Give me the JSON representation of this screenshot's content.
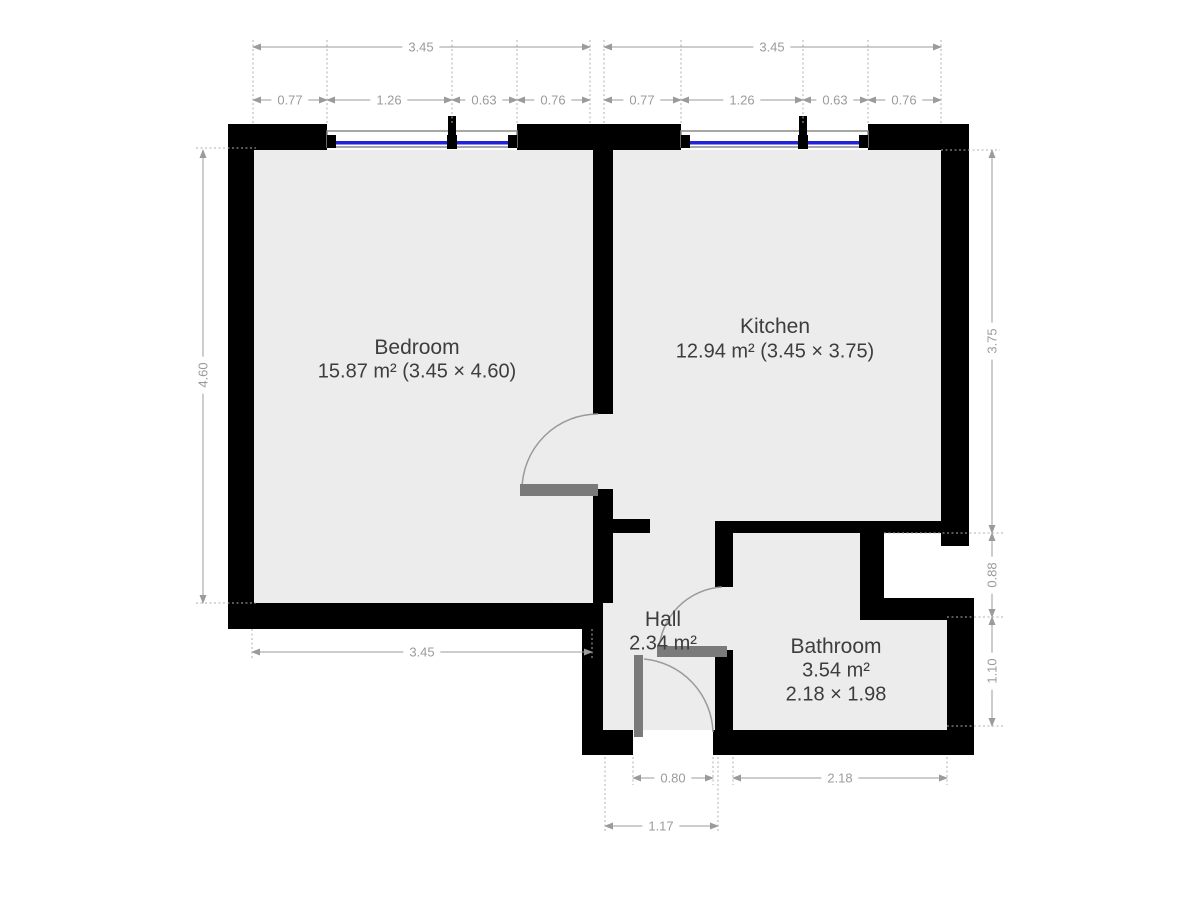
{
  "floorplan": {
    "rooms": [
      {
        "name": "Bedroom",
        "area_line": "15.87 m² (3.45 × 4.60)"
      },
      {
        "name": "Kitchen",
        "area_line": "12.94 m² (3.45 × 3.75)"
      },
      {
        "name": "Hall",
        "area_line": "2.34 m²"
      },
      {
        "name": "Bathroom",
        "area_line": "3.54 m²",
        "size_line": "2.18 × 1.98"
      }
    ],
    "dimensions": {
      "top_left": {
        "total": "3.45",
        "segments": [
          "0.77",
          "1.26",
          "0.63",
          "0.76"
        ]
      },
      "top_right": {
        "total": "3.45",
        "segments": [
          "0.77",
          "1.26",
          "0.63",
          "0.76"
        ]
      },
      "left": {
        "height": "4.60"
      },
      "right": {
        "upper": "3.75",
        "middle": "0.88",
        "lower": "1.10"
      },
      "bottom": {
        "bedroom_width": "3.45",
        "entry_door": "0.80",
        "bathroom_width": "2.18",
        "hall_width": "1.17"
      }
    },
    "colors": {
      "wall": "#000000",
      "floor": "#ececec",
      "window_glass": "#2222dd",
      "window_frame": "#8a8a8a",
      "door_leaf": "#7a7a7a",
      "door_arc": "#9a9a9a",
      "dimension": "#9b9b9b",
      "room_label": "#3d3d3d"
    }
  }
}
